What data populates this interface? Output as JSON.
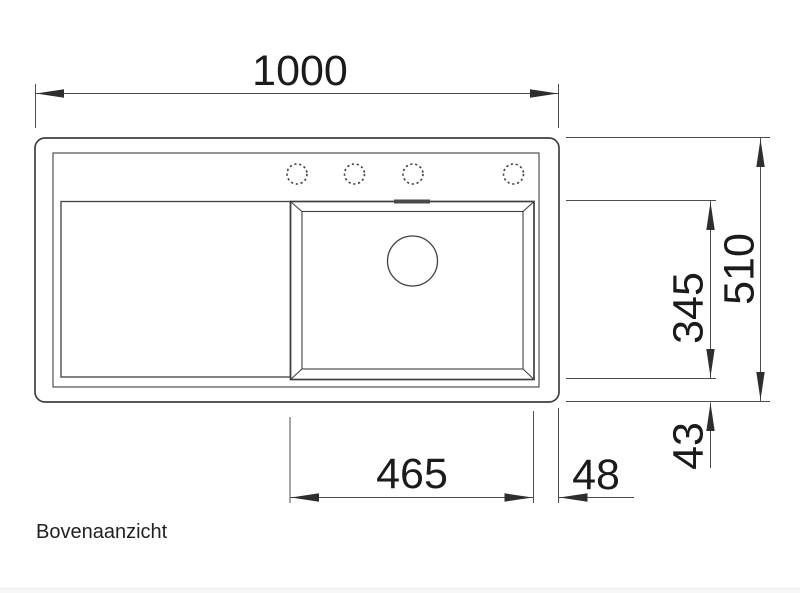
{
  "drawing": {
    "caption": "Bovenaanzicht",
    "dimensions": {
      "overall_width_mm": "1000",
      "overall_depth_mm": "510",
      "bowl_depth_mm": "345",
      "bowl_offset_bottom_mm": "43",
      "bowl_width_mm": "465",
      "bowl_offset_right_mm": "48"
    },
    "colors": {
      "background": "#ffffff",
      "line": "#3f3f3f",
      "dimension_line": "#4d4d4d",
      "text": "#1b1b1b"
    }
  }
}
